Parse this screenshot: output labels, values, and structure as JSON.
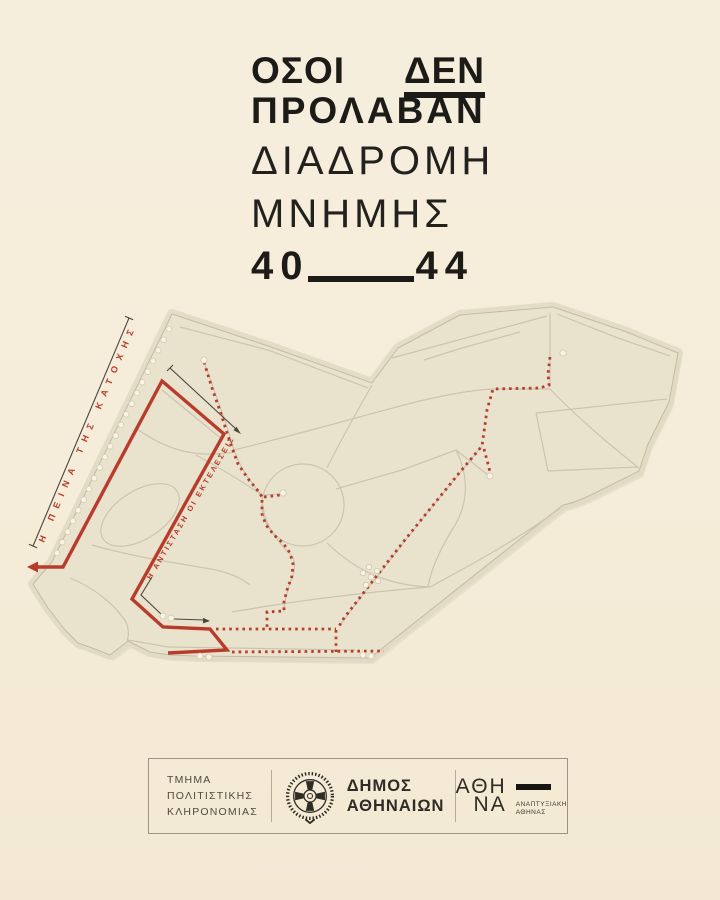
{
  "colors": {
    "bg": "#f5ecd9",
    "ink": "#1d1b18",
    "red": "#b73c2c",
    "park": "#e9e2cd",
    "park-edge": "#c3bca6",
    "path": "#cbc5b0",
    "halo": "#e0d8c1",
    "shadow": "#dcd3bc",
    "dot-fill": "#f8f3e3",
    "dot-edge": "#cfc8b2",
    "annot": "#4a463c",
    "footer-border": "#9b9484",
    "footer-text": "#4e4a42",
    "footer-dark": "#2f2c26"
  },
  "title": {
    "word1": "ΟΣΟΙ",
    "word2": "ΔΕΝ",
    "line2": "ΠΡΟΛΑΒΑΝ",
    "line3": "ΔΙΑΔΡΟΜΗ",
    "line4": "ΜΝΗΜΗΣ",
    "year_from": "40",
    "year_to": "44"
  },
  "map": {
    "label_famine": "Η ΠΕΙΝΑ ΤΗΣ ΚΑΤΟΧΗΣ",
    "label_resistance": "Η ΑΝΤΙΣΤΑΣΗ ΟΙ ΕΚΤΕΛΕΣΕΙΣ"
  },
  "footer": {
    "department_line1": "ΤΜΗΜΑ",
    "department_line2": "ΠΟΛΙΤΙΣΤΙΚΗΣ",
    "department_line3": "ΚΛΗΡΟΝΟΜΙΑΣ",
    "municipality_line1": "ΔΗΜΟΣ",
    "municipality_line2": "ΑΘΗΝΑΙΩΝ",
    "athina_line1": "ΑΘΗ",
    "athina_line2": "ΝΑ",
    "development_line1": "ΑΝΑΠΤΥΞΙΑΚΗ",
    "development_line2": "ΑΘΗΝΑΣ"
  }
}
